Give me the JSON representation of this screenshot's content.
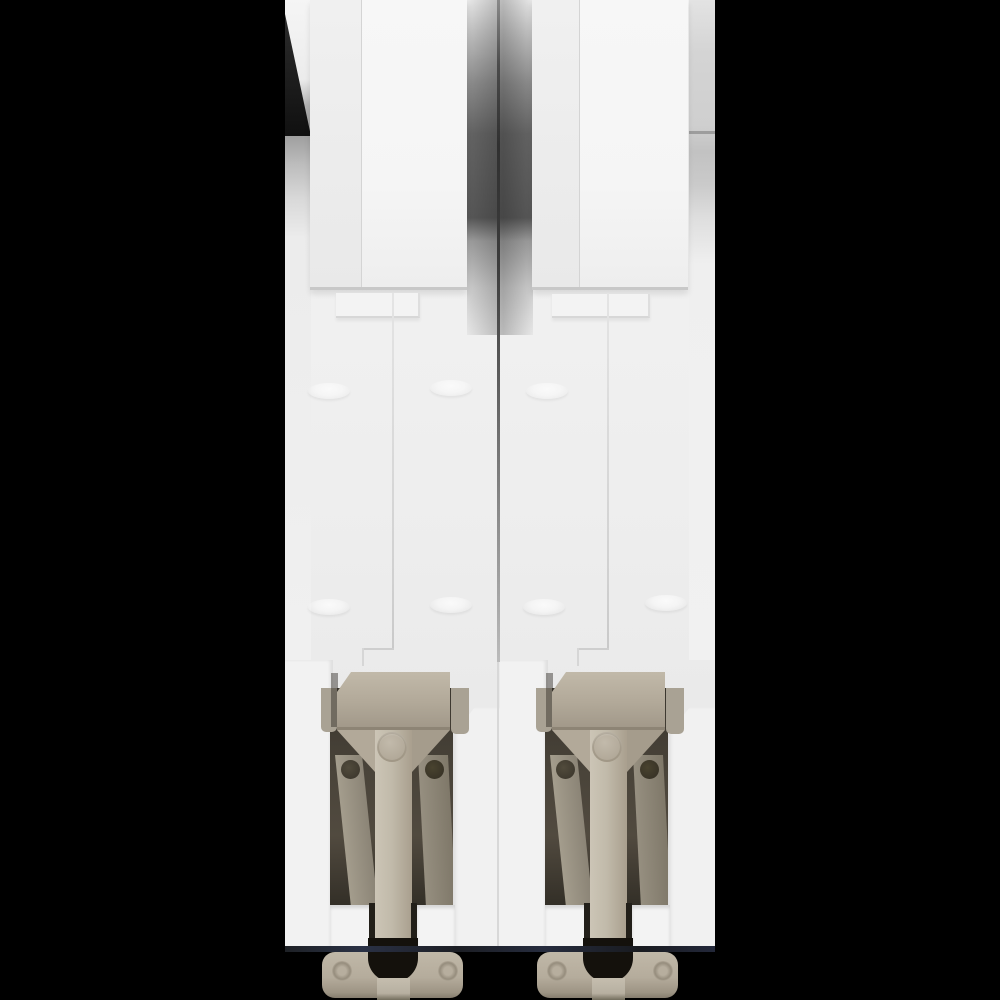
{
  "image": {
    "description": "Rear view product photo of a white 2-pole DIN-rail miniature circuit breaker with beige slider clips and mounting feet, centered on a black background"
  },
  "colors": {
    "bg": "#000000",
    "body": "#f0f0f0",
    "frame": "#f2f2f2",
    "tan": "#b2a999",
    "tandark": "#8d8475",
    "foot": "#b5ac9c",
    "slot": "#14110c",
    "cavity": "#3b362d",
    "gap_shadow": "#585858",
    "edge_blue": "#2a3145"
  },
  "parts": {
    "body": "White breaker housing, rear view",
    "left_tab": "Left pole top mounting hook tab",
    "right_tab": "Right pole top mounting hook tab",
    "left_clip": "Left pole DIN-rail clip assembly",
    "right_clip": "Right pole DIN-rail clip assembly",
    "slider": "Beige DIN-rail slider latch",
    "foot": "Beige mounting foot"
  }
}
